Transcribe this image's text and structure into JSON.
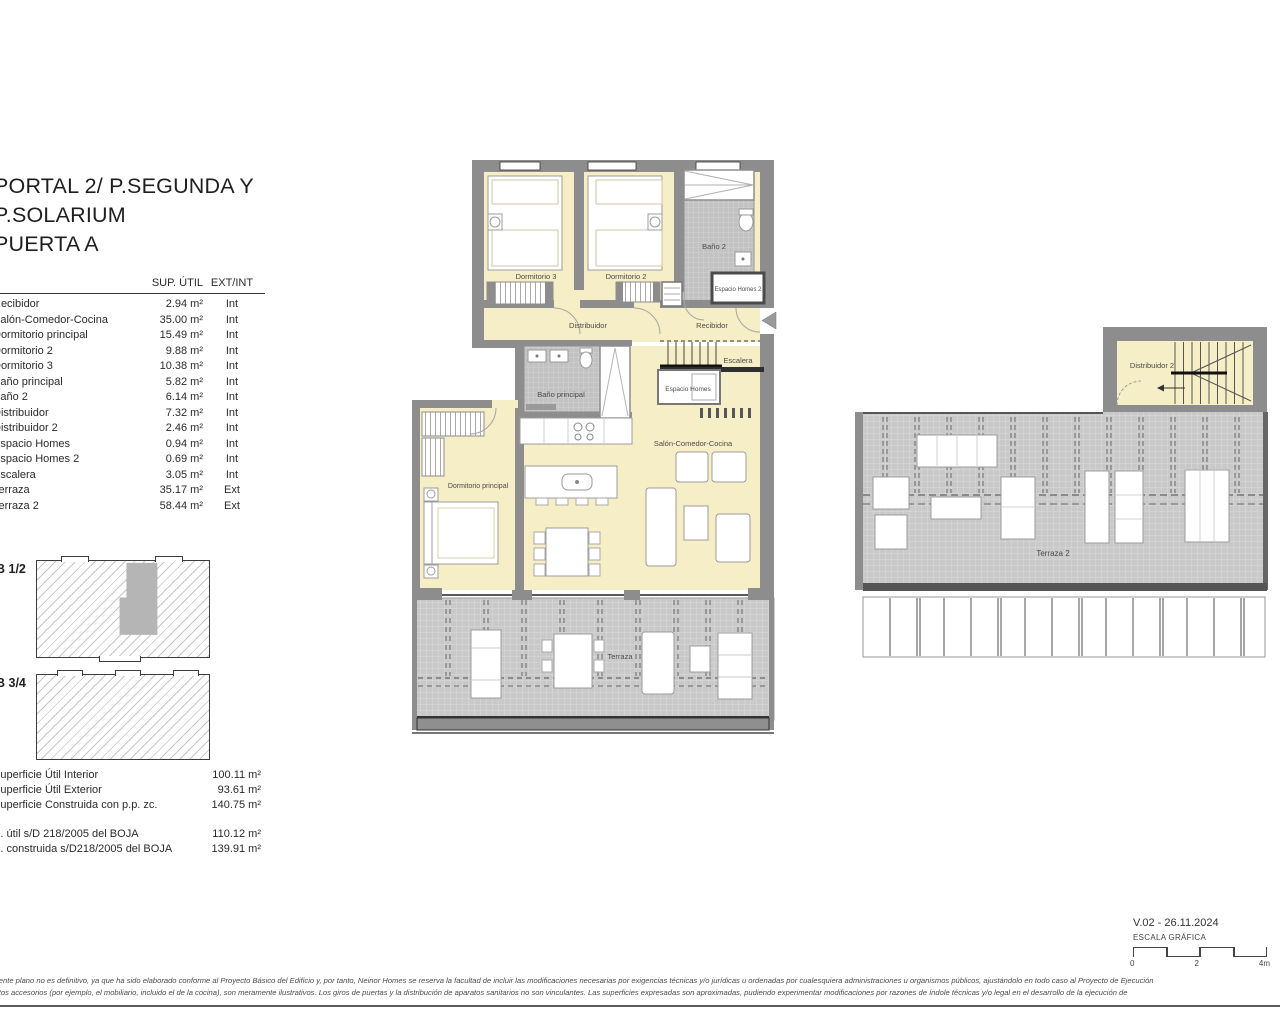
{
  "title": {
    "line1": "PORTAL 2/ P.SEGUNDA Y",
    "line2": "P.SOLARIUM",
    "line3": "PUERTA A"
  },
  "table": {
    "headers": {
      "area": "SUP. ÚTIL",
      "extint": "EXT/INT"
    },
    "rows": [
      {
        "name": "Recibidor",
        "area": "2.94 m²",
        "type": "Int"
      },
      {
        "name": "Salón-Comedor-Cocina",
        "area": "35.00 m²",
        "type": "Int"
      },
      {
        "name": "Dormitorio principal",
        "area": "15.49 m²",
        "type": "Int"
      },
      {
        "name": "Dormitorio 2",
        "area": "9.88 m²",
        "type": "Int"
      },
      {
        "name": "Dormitorio 3",
        "area": "10.38 m²",
        "type": "Int"
      },
      {
        "name": "Baño principal",
        "area": "5.82 m²",
        "type": "Int"
      },
      {
        "name": "Baño 2",
        "area": "6.14 m²",
        "type": "Int"
      },
      {
        "name": "Distribuidor",
        "area": "7.32 m²",
        "type": "Int"
      },
      {
        "name": "Distribuidor 2",
        "area": "2.46 m²",
        "type": "Int"
      },
      {
        "name": "Espacio Homes",
        "area": "0.94 m²",
        "type": "Int"
      },
      {
        "name": "Espacio Homes 2",
        "area": "0.69 m²",
        "type": "Int"
      },
      {
        "name": "Escalera",
        "area": "3.05 m²",
        "type": "Int"
      },
      {
        "name": "Terraza",
        "area": "35.17 m²",
        "type": "Ext"
      },
      {
        "name": "Terraza 2",
        "area": "58.44 m²",
        "type": "Ext"
      }
    ]
  },
  "keyplans": {
    "plan1": "B 1/2",
    "plan2": "B 3/4"
  },
  "summary": {
    "rows": [
      {
        "name": "Superficie Útil Interior",
        "value": "100.11 m²"
      },
      {
        "name": "Superficie Útil Exterior",
        "value": "93.61 m²"
      },
      {
        "name": "Superficie Construida con p.p. zc.",
        "value": "140.75 m²"
      }
    ],
    "rows2": [
      {
        "name": "S. útil s/D 218/2005 del BOJA",
        "value": "110.12 m²"
      },
      {
        "name": "S. construida s/D218/2005 del BOJA",
        "value": "139.91 m²"
      }
    ]
  },
  "plan": {
    "dormitorio3": "Dormitorio 3",
    "dormitorio2": "Dormitorio 2",
    "bano2": "Baño 2",
    "espacio_homes2": "Espacio Homes 2",
    "distribuidor": "Distribuidor",
    "recibidor": "Recibidor",
    "escalera": "Escalera",
    "espacio_homes": "Espacio Homes",
    "bano_principal": "Baño principal",
    "salon": "Salón-Comedor-Cocina",
    "dormitorio_principal": "Dormitorio principal",
    "terraza": "Terraza"
  },
  "solarium": {
    "distribuidor2": "Distribuidor 2",
    "terraza2": "Terraza 2"
  },
  "footer": {
    "version": "V.02 - 26.11.2024",
    "scale_label": "ESCALA GRÁFICA",
    "tick0": "0",
    "tick2": "2",
    "tick4": "4m",
    "disclaimer_line1": "presente plano no es definitivo, ya que ha sido elaborado conforme al Proyecto Básico del Edificio y, por tanto, Neinor Homes se reserva la facultad de incluir las modificaciones necesarias por exigencias técnicas y/o jurídicas u ordenadas por cualesquiera administraciones u organismos públicos, ajustándolo en todo caso al Proyecto de Ejecución",
    "disclaimer_line2": "mentos accesorios (por ejemplo, el mobiliario, incluido el de la cocina), son meramente ilustrativos. Los giros de puertas y la distribución de aparatos sanitarios no son vinculantes. Las superficies expresadas son aproximadas, pudiendo experimentar modificaciones por razones de índole técnicas y/o legal en el desarrollo de la ejecución de"
  },
  "colors": {
    "room_fill": "#f6eec6",
    "wall": "#8d8d8d",
    "tile": "#c9c9c9",
    "bath_tile": "#c2c2c2",
    "highlight_unit": "#b5b5b5"
  }
}
